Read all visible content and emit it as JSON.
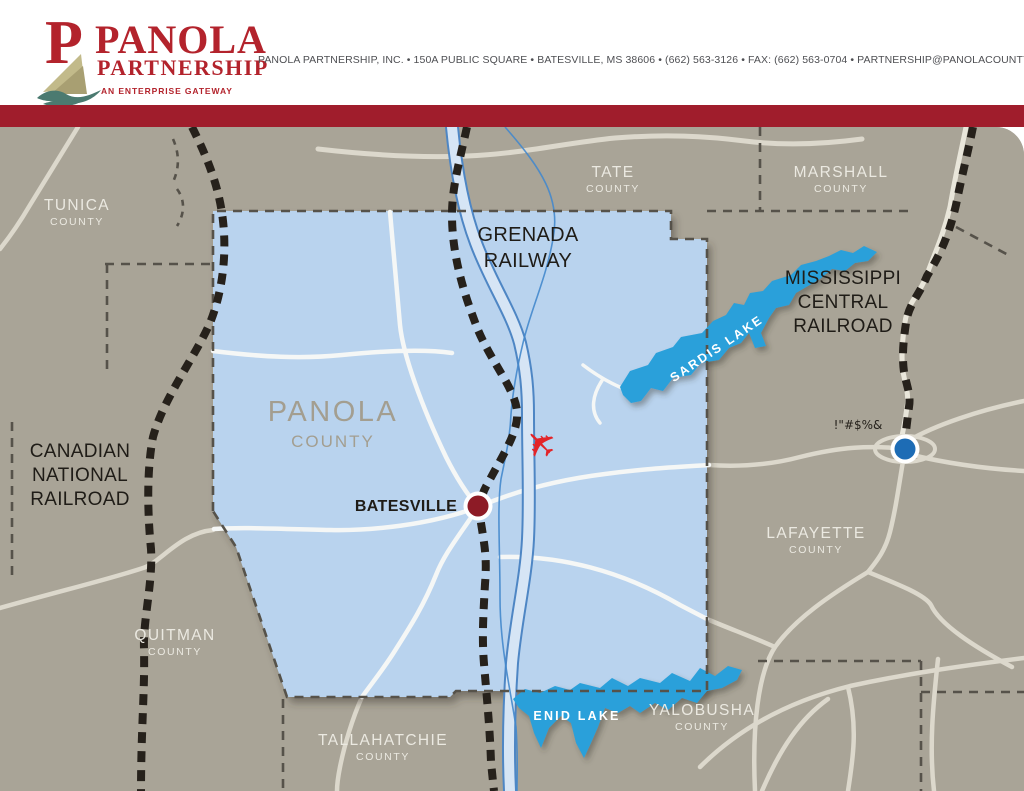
{
  "header": {
    "logo": {
      "line1": "PANOLA",
      "line2": "PARTNERSHIP",
      "tagline": "AN ENTERPRISE GATEWAY"
    },
    "contact": "PANOLA PARTNERSHIP, INC.  •  150A PUBLIC SQUARE  •  BATESVILLE, MS 38606  •  (662) 563-3126  •  FAX: (662) 563-0704  •  PARTNERSHIP@PANOLACOUNTY.COM  •  PANOLACOUNTY.COM"
  },
  "map": {
    "counties": {
      "tunica": {
        "name": "TUNICA",
        "sub": "COUNTY"
      },
      "tate": {
        "name": "TATE",
        "sub": "COUNTY"
      },
      "marshall": {
        "name": "MARSHALL",
        "sub": "COUNTY"
      },
      "panola": {
        "name": "PANOLA",
        "sub": "COUNTY"
      },
      "lafayette": {
        "name": "LAFAYETTE",
        "sub": "COUNTY"
      },
      "quitman": {
        "name": "QUITMAN",
        "sub": "COUNTY"
      },
      "tallahatchie": {
        "name": "TALLAHATCHIE",
        "sub": "COUNTY"
      },
      "yalobusha": {
        "name": "YALOBUSHA",
        "sub": "COUNTY"
      }
    },
    "railroads": {
      "canadian": [
        "CANADIAN",
        "NATIONAL",
        "RAILROAD"
      ],
      "grenada": [
        "GRENADA",
        "RAILWAY"
      ],
      "ms_central": [
        "MISSISSIPPI",
        "CENTRAL",
        "RAILROAD"
      ]
    },
    "cities": {
      "batesville": "BATESVILLE",
      "oxford": "!\"#$%&"
    },
    "lakes": {
      "sardis": "SARDIS LAKE",
      "enid": "ENID LAKE"
    },
    "plane_glyph": "✈",
    "colors": {
      "header_bar": "#a01d2c",
      "logo_red": "#b3232c",
      "map_base": "#a9a497",
      "county_fill": "#b9d3ee",
      "lake_blue": "#2aa0da",
      "railroad_black": "#26211b",
      "interstate_edge": "#4e86c4",
      "interstate_fill": "#d6e5f5",
      "batesville_marker": "#8d1b26",
      "oxford_marker": "#1d6cb5",
      "plane_red": "#e32428"
    }
  }
}
